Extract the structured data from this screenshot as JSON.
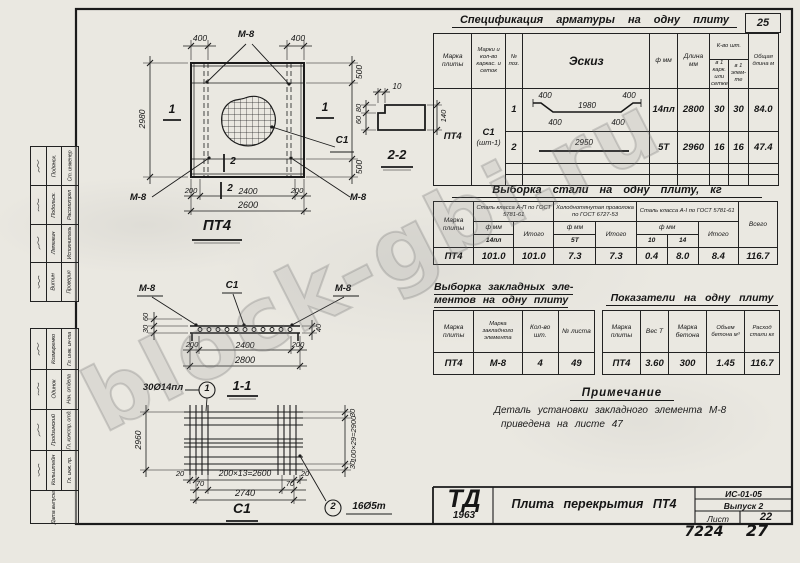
{
  "watermark": "block-gbi.ru",
  "page": {
    "corner_number": "25",
    "footer_code": "7224",
    "footer_page": "27"
  },
  "stamps": {
    "upper": [
      {
        "role": "Ст. инженер",
        "name": "Подянск."
      },
      {
        "role": "Рассмотрел",
        "name": "Подольск."
      },
      {
        "role": "Исполнитель",
        "name": "Ляпежин"
      },
      {
        "role": "Проверил",
        "name": "Витин"
      }
    ],
    "lower": [
      {
        "role": "Гл. инж. ин-та",
        "name": "Козмиренко"
      },
      {
        "role": "Нач. отдела",
        "name": "Одинок"
      },
      {
        "role": "Гл. констр. отд.",
        "name": "Гродзинский"
      },
      {
        "role": "Гл. инж. пр.",
        "name": "Кольштейн"
      }
    ],
    "date_label": "Дата выпуска"
  },
  "plan": {
    "title": "ПТ4",
    "m8": "М-8",
    "c1": "С1",
    "sec1": "1",
    "sec2": "2",
    "dim_top_left": "400",
    "dim_top_right": "400",
    "dim_left": "2980",
    "dim_right_top": "500",
    "dim_right_bottom": "500",
    "dim_bot_1": "200",
    "dim_bot_2": "2400",
    "dim_bot_3": "200",
    "dim_bot_total": "2600"
  },
  "section22": {
    "title": "2-2",
    "dim_top": "10",
    "dim_left_top": "80",
    "dim_left_bot": "60",
    "dim_right": "140"
  },
  "section11": {
    "title": "1-1",
    "m8": "М-8",
    "c1": "С1",
    "dim_left_top": "60",
    "dim_left_bot": "30",
    "dim_right": "40",
    "dim_bot_1": "200",
    "dim_bot_2": "2400",
    "dim_bot_3": "200",
    "dim_bot_total": "2800",
    "callout_num": "1",
    "callout_text": "30Ø14пл"
  },
  "mesh": {
    "title": "С1",
    "dim_left": "2960",
    "dim_right_top": "30",
    "dim_right_mid": "100×29=2900",
    "dim_right_bot": "30",
    "dim_bot_left": "20",
    "dim_bot_mid": "200×13=2600",
    "dim_bot_right": "20",
    "dim_bot_70l": "70",
    "dim_bot_70r": "70",
    "dim_bot_total": "2740",
    "callout_num": "2",
    "callout_text": "16Ø5т"
  },
  "spec": {
    "title": "Спецификация арматуры на одну плиту",
    "h_marka": "Марка плиты",
    "h_karkas": "Марки и кол-во каркас. и сеток",
    "h_pos": "№ поз.",
    "h_eskiz": "Эскиз",
    "h_dia": "ф мм",
    "h_len": "Длина мм",
    "h_qty": "К-во шт.",
    "h_qty1": "в 1 карк. или сетке",
    "h_qty2": "в 1 элем-те",
    "h_total": "Общая длина м",
    "marka": "ПТ4",
    "karkas1": "С1",
    "karkas2": "(шт-1)",
    "rows": [
      {
        "pos": "1",
        "dia": "14пл",
        "len": "2800",
        "q1": "30",
        "q2": "30",
        "total": "84.0",
        "s_tl": "400",
        "s_tc": "1980",
        "s_tr": "400",
        "s_bl": "400",
        "s_br": "400"
      },
      {
        "pos": "2",
        "dia": "5Т",
        "len": "2960",
        "q1": "16",
        "q2": "16",
        "total": "47.4",
        "s_c": "2950"
      }
    ]
  },
  "steel": {
    "title": "Выборка стали на одну плиту, кг",
    "h_marka": "Марка плиты",
    "g1": "Сталь класса А-П по ГОСТ 5781-61",
    "g2": "Холоднотянутая проволока по ГОСТ 6727-53",
    "g3": "Сталь класса А-I по ГОСТ 5781-61",
    "h_dia": "ф мм",
    "h_itogo": "Итого",
    "h_vsego": "Всего",
    "d1": "14пл",
    "d2": "5Т",
    "d3a": "10",
    "d3b": "14",
    "row": {
      "marka": "ПТ4",
      "v1": "101.0",
      "i1": "101.0",
      "v2": "7.3",
      "i2": "7.3",
      "v3a": "0.4",
      "v3b": "8.0",
      "i3": "8.4",
      "total": "116.7"
    }
  },
  "embeds": {
    "title1": "Выборка закладных эле-",
    "title2": "ментов на одну плиту",
    "h_marka": "Марка плиты",
    "h_mark_el": "Марка закладного элемента",
    "h_qty": "Кол-во шт.",
    "h_sheet": "№ листа",
    "row": {
      "marka": "ПТ4",
      "mark_el": "М-8",
      "qty": "4",
      "sheet": "49"
    }
  },
  "indicators": {
    "title": "Показатели на одну плиту",
    "h_marka": "Марка плиты",
    "h_weight": "Вес Т",
    "h_concrete": "Марка бетона",
    "h_volume": "Объем бетона м³",
    "h_steel": "Расход стали кг",
    "row": {
      "marka": "ПТ4",
      "weight": "3.60",
      "concrete": "300",
      "volume": "1.45",
      "steel": "116.7"
    }
  },
  "note": {
    "title": "Примечание",
    "line1": "Деталь установки закладного элемента М-8",
    "line2": "приведена на листе 47"
  },
  "titleblock": {
    "logo": "ТД",
    "year": "1963",
    "title": "Плита перекрытия ПТ4",
    "code": "ИС-01-05",
    "issue": "Выпуск 2",
    "sheet_label": "Лист",
    "sheet_no": "22"
  }
}
